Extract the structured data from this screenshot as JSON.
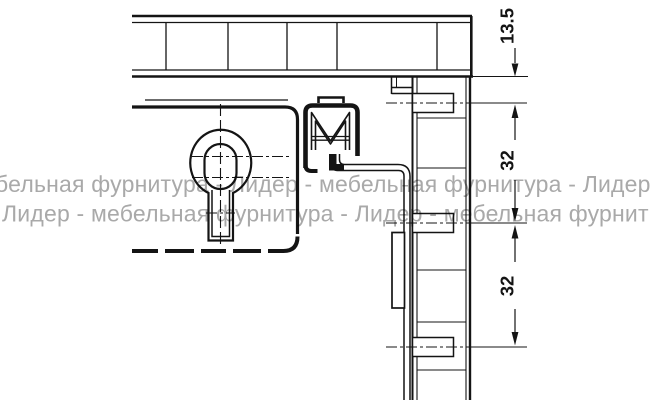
{
  "watermark": {
    "line1": "бельная фурнитура - Лидер - мебельная фурнитура - Лидер",
    "line2": "Лидер - мебельная фурнитура - Лидер - мебельная фурнит"
  },
  "dimensions": [
    {
      "id": "top-offset",
      "label": "13.5",
      "unit": "mm"
    },
    {
      "id": "hole-spacing-upper",
      "label": "32",
      "unit": "mm"
    },
    {
      "id": "hole-spacing-lower",
      "label": "32",
      "unit": "mm"
    }
  ],
  "colors": {
    "line": "#141414",
    "watermark": "#a9a9a9",
    "background": "#ffffff"
  }
}
